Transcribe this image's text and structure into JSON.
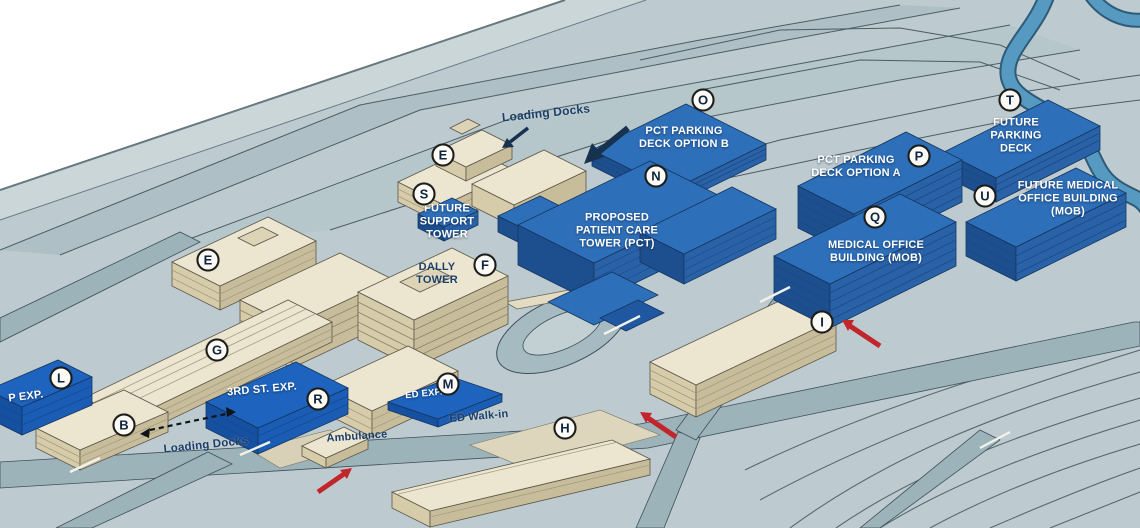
{
  "map_title": "",
  "colors": {
    "proposed_blue": "#2e6fb9",
    "proposed_blue_bright": "#1e63bd",
    "existing_tan": "#ece5cf",
    "ground": "#bdcbd0",
    "road": "#9db4bb",
    "river": "#569ac2",
    "label_light": "#ffffff",
    "label_dark": "#1d3f66",
    "marker_ring": "#1c1c1a",
    "arrow_red": "#c2262c",
    "arrow_dark": "#16324f"
  },
  "icons": [
    "loading-dock-arrow-icon",
    "route-dashed-arrow-icon",
    "red-access-arrow-icon"
  ],
  "markers": [
    {
      "letter": "E"
    },
    {
      "letter": "S"
    },
    {
      "letter": "O"
    },
    {
      "letter": "N"
    },
    {
      "letter": "P"
    },
    {
      "letter": "T"
    },
    {
      "letter": "U"
    },
    {
      "letter": "Q"
    },
    {
      "letter": "E"
    },
    {
      "letter": "F"
    },
    {
      "letter": "G"
    },
    {
      "letter": "L"
    },
    {
      "letter": "B"
    },
    {
      "letter": "R"
    },
    {
      "letter": "M"
    },
    {
      "letter": "H"
    },
    {
      "letter": "I"
    }
  ],
  "labels": [
    {
      "id": "loading-docks-top",
      "text": "Loading Docks"
    },
    {
      "id": "pct-parking-deck-option-b",
      "text": "PCT PARKING DECK OPTION B"
    },
    {
      "id": "future-support-tower",
      "text": "FUTURE SUPPORT TOWER"
    },
    {
      "id": "proposed-patient-care-tower",
      "text": "PROPOSED PATIENT CARE TOWER (PCT)"
    },
    {
      "id": "dally-tower",
      "text": "DALLY TOWER"
    },
    {
      "id": "pct-parking-deck-option-a",
      "text": "PCT PARKING DECK OPTION A"
    },
    {
      "id": "future-parking-deck",
      "text": "FUTURE PARKING DECK"
    },
    {
      "id": "future-medical-office-building",
      "text": "FUTURE MEDICAL OFFICE BUILDING (MOB)"
    },
    {
      "id": "medical-office-building",
      "text": "MEDICAL OFFICE BUILDING (MOB)"
    },
    {
      "id": "third-st-exp",
      "text": "3RD ST. EXP."
    },
    {
      "id": "p-exp",
      "text": "P EXP."
    },
    {
      "id": "ed-exp",
      "text": "ED EXP."
    },
    {
      "id": "ed-walk-in",
      "text": "ED Walk-in"
    },
    {
      "id": "ambulance",
      "text": "Ambulance"
    },
    {
      "id": "loading-docks-bottom",
      "text": "Loading Docks"
    }
  ]
}
